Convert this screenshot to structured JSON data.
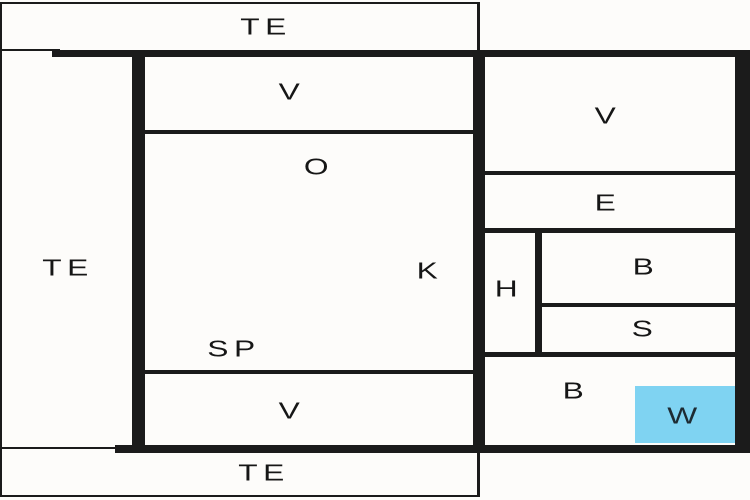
{
  "plan": {
    "type": "floor-plan",
    "background_color": "#fdfcfa",
    "wall_color": "#1b1b1b",
    "label_color": "#161616",
    "highlight_color": "#7fd3f2",
    "rooms": {
      "te_top": {
        "label": "TE"
      },
      "te_left": {
        "label": "TE"
      },
      "te_bottom": {
        "label": "TE"
      },
      "v_upper_mid": {
        "label": "V"
      },
      "o": {
        "label": "O"
      },
      "k": {
        "label": "K"
      },
      "sp": {
        "label": "SP"
      },
      "v_lower_mid": {
        "label": "V"
      },
      "v_right": {
        "label": "V"
      },
      "e": {
        "label": "E"
      },
      "h": {
        "label": "H"
      },
      "b_upper": {
        "label": "B"
      },
      "s": {
        "label": "S"
      },
      "b_lower": {
        "label": "B"
      },
      "w": {
        "label": "W",
        "highlighted": true
      }
    }
  }
}
